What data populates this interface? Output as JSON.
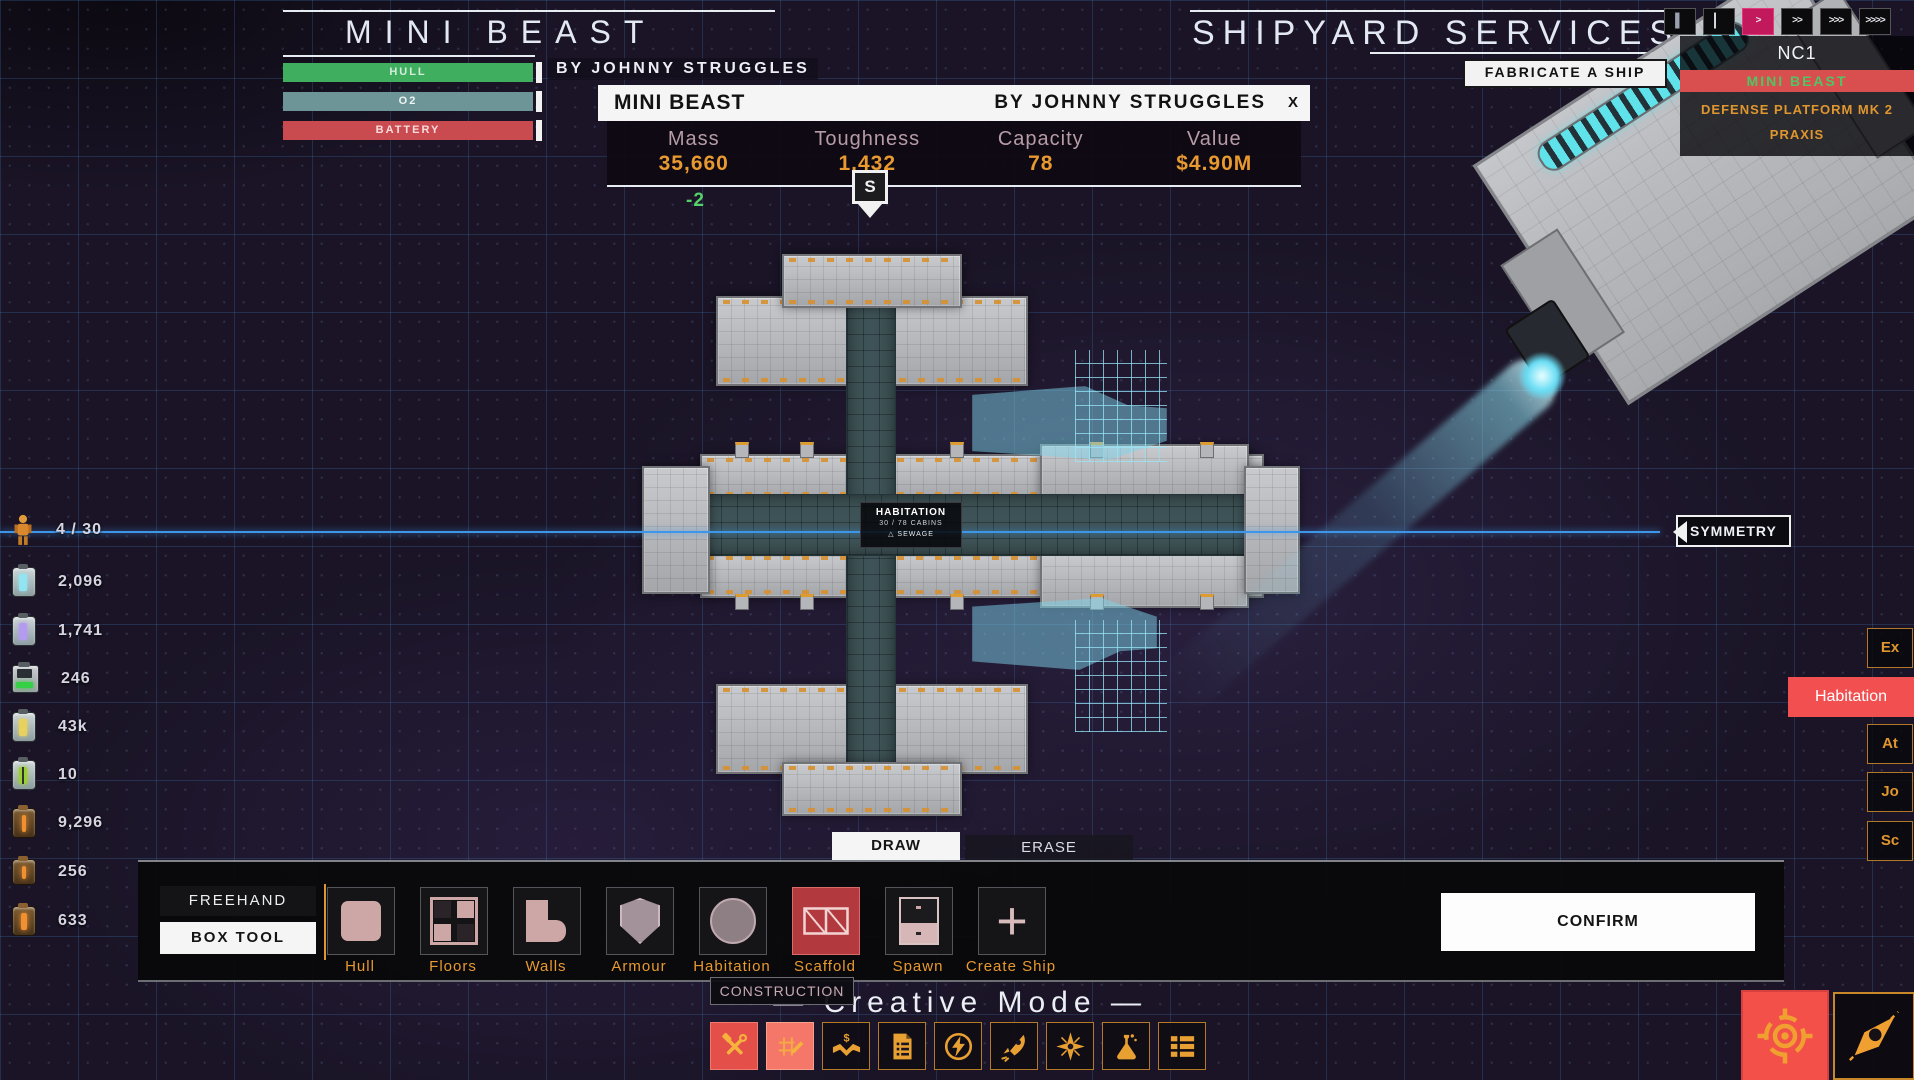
{
  "colors": {
    "accent_orange": "#e8992f",
    "danger_red": "#e8544e",
    "magenta": "#c2195c",
    "cyan": "#6fd8ef",
    "green": "#4cae5f",
    "symmetry_blue": "#3e96e8"
  },
  "header": {
    "ship_title": "MINI BEAST",
    "ship_author": "BY JOHNNY STRUGGLES",
    "right_title": "SHIPYARD SERVICES",
    "bars": [
      {
        "label": "HULL",
        "color": "#3fae5f"
      },
      {
        "label": "O2",
        "color": "#6d9496"
      },
      {
        "label": "BATTERY",
        "color": "#c94b50"
      }
    ]
  },
  "fabricate": {
    "label": "FABRICATE A SHIP"
  },
  "speed": {
    "buttons": [
      "▍",
      "▏",
      ">",
      ">>",
      ">>>",
      ">>>>"
    ],
    "active_index": 2
  },
  "fleet": {
    "system": "NC1",
    "ships": [
      {
        "name": "MINI BEAST",
        "selected": true
      },
      {
        "name": "DEFENSE PLATFORM MK 2",
        "selected": false
      },
      {
        "name": "PRAXIS",
        "selected": false
      }
    ]
  },
  "info": {
    "title": "MINI BEAST",
    "author": "BY JOHNNY STRUGGLES",
    "close": "X",
    "stats": [
      {
        "label": "Mass",
        "value": "35,660"
      },
      {
        "label": "Toughness",
        "value": "1,432"
      },
      {
        "label": "Capacity",
        "value": "78"
      },
      {
        "label": "Value",
        "value": "$4.90M"
      }
    ],
    "delta": "-2",
    "marker": "S"
  },
  "resources": [
    {
      "icon": "crew-icon",
      "value": "4 / 30"
    },
    {
      "icon": "o2-canister-icon",
      "value": "2,096"
    },
    {
      "icon": "fuel-canister-icon",
      "value": "1,741"
    },
    {
      "icon": "battery-icon",
      "value": "246"
    },
    {
      "icon": "gold-canister-icon",
      "value": "43k"
    },
    {
      "icon": "bio-canister-icon",
      "value": "10"
    },
    {
      "icon": "machine-part-icon",
      "value": "9,296"
    },
    {
      "icon": "machine-part-icon",
      "value": "256"
    },
    {
      "icon": "machine-part-icon",
      "value": "633"
    }
  ],
  "canvas": {
    "symmetry": "SYMMETRY",
    "hab": {
      "title": "HABITATION",
      "cabins": "30 / 78 CABINS",
      "warning": "△ SEWAGE"
    }
  },
  "right_tabs": [
    {
      "label": "Ex",
      "highlight": false
    },
    {
      "label": "Habitation",
      "highlight": true
    },
    {
      "label": "At",
      "highlight": false
    },
    {
      "label": "Jo",
      "highlight": false
    },
    {
      "label": "Sc",
      "highlight": false
    }
  ],
  "build": {
    "tabs": [
      {
        "label": "DRAW",
        "active": true
      },
      {
        "label": "ERASE",
        "active": false
      }
    ],
    "modes": [
      {
        "label": "FREEHAND",
        "active": false
      },
      {
        "label": "BOX TOOL",
        "active": true
      }
    ],
    "tools": [
      {
        "label": "Hull",
        "icon": "hull-icon",
        "selected": false
      },
      {
        "label": "Floors",
        "icon": "floors-icon",
        "selected": false
      },
      {
        "label": "Walls",
        "icon": "walls-icon",
        "selected": false
      },
      {
        "label": "Armour",
        "icon": "armour-icon",
        "selected": false
      },
      {
        "label": "Habitation",
        "icon": "habitation-icon",
        "selected": false
      },
      {
        "label": "Scaffold",
        "icon": "scaffold-icon",
        "selected": true
      },
      {
        "label": "Spawn",
        "icon": "spawn-icon",
        "selected": false
      },
      {
        "label": "Create Ship",
        "icon": "create-ship-icon",
        "selected": false
      }
    ],
    "confirm": "CONFIRM",
    "category": "CONSTRUCTION"
  },
  "footer": {
    "mode_label": "—  Creative Mode  —",
    "menu": [
      {
        "icon": "build-tools-icon",
        "active": true
      },
      {
        "icon": "draw-plan-icon",
        "active": true
      },
      {
        "icon": "trade-icon",
        "active": false
      },
      {
        "icon": "contracts-icon",
        "active": false
      },
      {
        "icon": "power-icon",
        "active": false
      },
      {
        "icon": "thrusters-icon",
        "active": false
      },
      {
        "icon": "navigation-icon",
        "active": false
      },
      {
        "icon": "research-icon",
        "active": false
      },
      {
        "icon": "inventory-icon",
        "active": false
      }
    ]
  },
  "corner_buttons": [
    {
      "icon": "target-icon",
      "active": true
    },
    {
      "icon": "ship-nav-icon",
      "active": false
    }
  ]
}
